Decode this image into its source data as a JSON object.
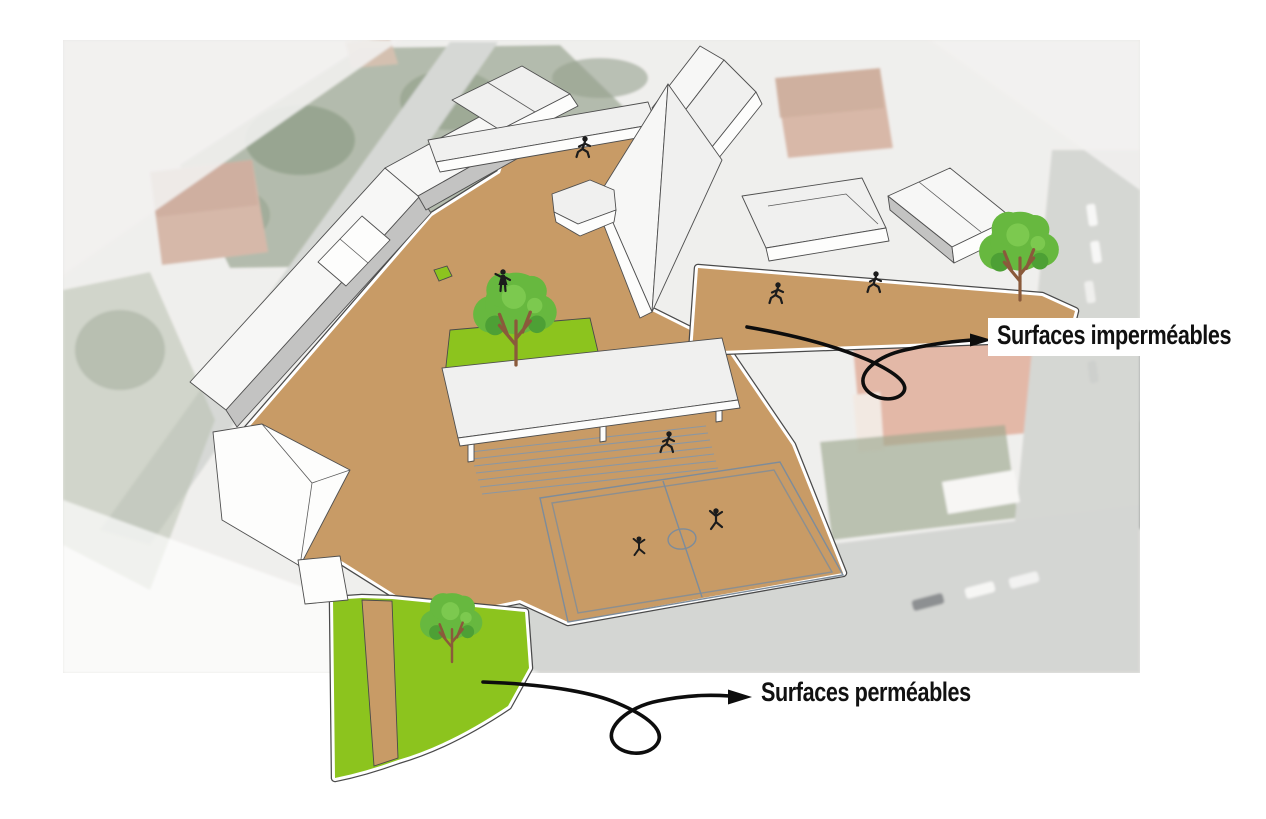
{
  "annotations": [
    {
      "id": "impermeable-surfaces",
      "label": "Surfaces imperméables"
    },
    {
      "id": "permeable-surfaces",
      "label": "Surfaces perméables"
    }
  ],
  "palette": {
    "impermeable": "#c89b66",
    "permeable": "#8cc41e",
    "tree-canopy": "#67b83f",
    "tree-canopy-dark": "#4da035",
    "tree-canopy-light": "#7cc94f",
    "tree-trunk": "#8a5a3b",
    "arrow": "#0d0d0d",
    "court-line": "#7d8c9b",
    "label-text": "#111111",
    "label-bg": "#ffffff"
  }
}
